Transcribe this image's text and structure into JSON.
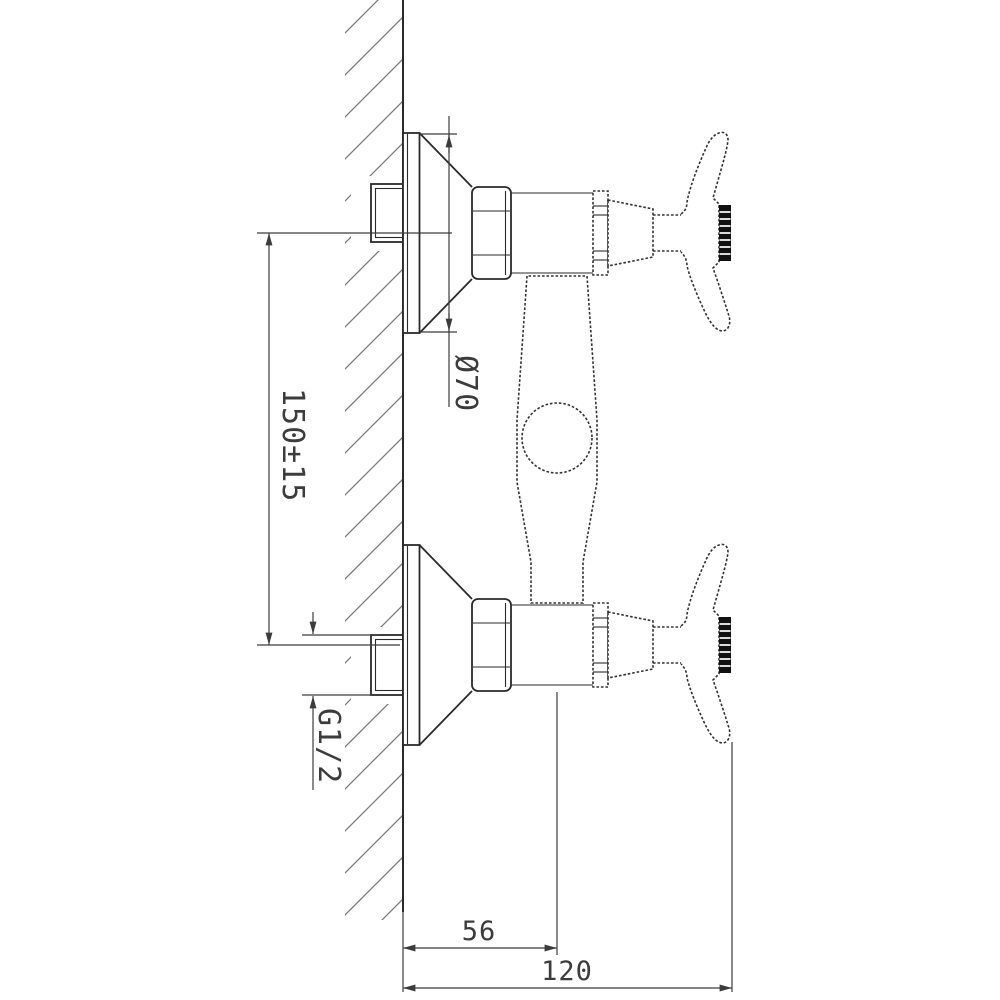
{
  "drawing": {
    "kind": "technical-drawing",
    "view": "side-section"
  },
  "dimensions": {
    "center_distance": "150±15",
    "flange_diameter": "Ø70",
    "thread_size": "G1/2",
    "body_offset": "56",
    "overall_depth": "120"
  },
  "colors": {
    "background": "#ffffff",
    "outline": "#2a2a2a",
    "dimension": "#3c3c3c",
    "hatch": "#7a7a7a",
    "knurl": "#111111"
  }
}
